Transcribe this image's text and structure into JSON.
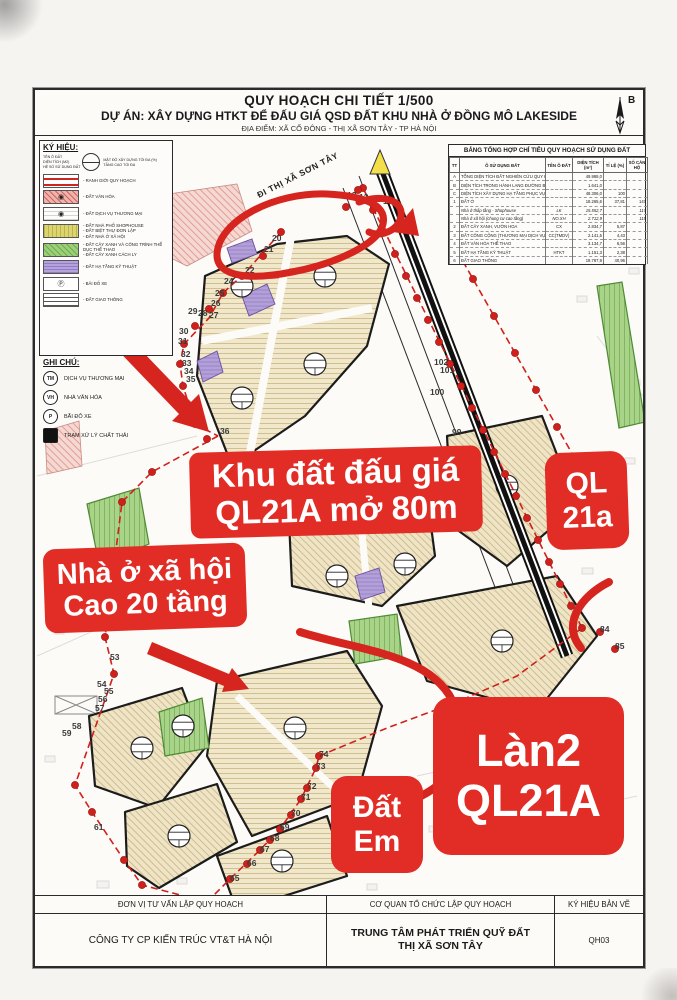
{
  "title_block": {
    "line1": "QUY HOẠCH CHI TIẾT 1/500",
    "line2": "DỰ ÁN: XÂY DỰNG HTKT ĐỂ ĐẤU GIÁ QSD ĐẤT KHU NHÀ Ở ĐỒNG MÔ LAKESIDE",
    "line3": "ĐỊA ĐIỂM: XÃ CỔ ĐÔNG - THỊ XÃ SƠN TÂY - TP HÀ NỘI",
    "north_label": "B"
  },
  "legend": {
    "title": "KÝ HIỆU:",
    "callout": {
      "left": [
        "TÊN Ô ĐẤT",
        "DIỆN TÍCH (M2)",
        "HỆ SỐ SỬ DỤNG ĐẤT"
      ],
      "right": [
        "MẬT ĐỘ XÂY DỰNG TỐI ĐA (%)",
        "TẦNG CAO TỐI ĐA"
      ]
    },
    "items": [
      {
        "swatch": "boundary",
        "icon": "",
        "lines": [
          "RANH GIỚI QUY HOẠCH"
        ]
      },
      {
        "swatch": "culture",
        "icon": "◉",
        "lines": [
          "ĐẤT VĂN HÓA"
        ]
      },
      {
        "swatch": "commerce",
        "icon": "◉",
        "lines": [
          "ĐẤT DỊCH VỤ THƯƠNG MẠI"
        ]
      },
      {
        "swatch": "residential",
        "icon": "",
        "lines": [
          "ĐẤT NHÀ PHỐ SHOPHOUSE",
          "ĐẤT BIỆT THỰ ĐƠN LẬP",
          "ĐẤT NHÀ Ở XÃ HỘI"
        ]
      },
      {
        "swatch": "green",
        "icon": "",
        "lines": [
          "ĐẤT CÂY XANH VÀ CÔNG TRÌNH THỂ DỤC THỂ THAO",
          "ĐẤT CÂY XANH CÁCH LY"
        ]
      },
      {
        "swatch": "technical",
        "icon": "",
        "lines": [
          "ĐẤT HẠ TẦNG KỸ THUẬT"
        ]
      },
      {
        "swatch": "parking",
        "icon": "Ⓟ",
        "lines": [
          "BÃI ĐỖ XE"
        ]
      },
      {
        "swatch": "road",
        "icon": "",
        "lines": [
          "ĐẤT GIAO THÔNG"
        ]
      }
    ],
    "notes_title": "GHI CHÚ:",
    "notes": [
      {
        "glyph": "TM",
        "label": "DỊCH VỤ THƯƠNG MẠI"
      },
      {
        "glyph": "VH",
        "label": "NHÀ VĂN HÓA"
      },
      {
        "glyph": "P",
        "label": "BÃI ĐỖ XE"
      },
      {
        "glyph": "▪",
        "label": "TRẠM XỬ LÝ CHẤT THẢI"
      }
    ]
  },
  "land_use_table": {
    "title": "BẢNG TỔNG HỢP CHỈ TIÊU QUY HOẠCH SỬ DỤNG ĐẤT",
    "columns": [
      "TT",
      "Ô SỬ DỤNG ĐẤT",
      "TÊN Ô ĐẤT",
      "DIỆN TÍCH (m²)",
      "TỈ LỆ (%)",
      "SỐ CĂN HỘ"
    ],
    "rows": [
      {
        "tt": "A",
        "name": "TỔNG DIỆN TÍCH ĐẤT NGHIÊN CỨU QUY HOẠCH",
        "code": "",
        "area": "49.988,0",
        "ratio": "",
        "units": "",
        "sub": false
      },
      {
        "tt": "B",
        "name": "DIỆN TÍCH TRONG HÀNH LANG ĐƯỜNG BỘ",
        "code": "",
        "area": "1.641,0",
        "ratio": "",
        "units": "",
        "sub": false
      },
      {
        "tt": "C",
        "name": "DIỆN TÍCH XÂY DỰNG HẠ TẦNG PHỤC VỤ ĐẤU GIÁ",
        "code": "",
        "area": "48.306,0",
        "ratio": "100",
        "units": "",
        "sub": false
      },
      {
        "tt": "1",
        "name": "ĐẤT Ở",
        "code": "",
        "area": "18.265,6",
        "ratio": "37,81",
        "units": "147",
        "sub": false
      },
      {
        "tt": "",
        "name": "Nhà ở thấp tầng - Shophouse",
        "code": "LK",
        "area": "15.552,7",
        "ratio": "",
        "units": "117",
        "sub": true
      },
      {
        "tt": "",
        "name": "Nhà ở xã hội (chung cư cao tầng)",
        "code": "NO.XH",
        "area": "2.712,9",
        "ratio": "",
        "units": "119",
        "sub": true
      },
      {
        "tt": "2",
        "name": "ĐẤT CÂY XANH, VƯỜN HOA",
        "code": "CX",
        "area": "2.834,7",
        "ratio": "5,87",
        "units": "",
        "sub": false
      },
      {
        "tt": "3",
        "name": "ĐẤT CÔNG CỘNG (THƯƠNG MẠI DỊCH VỤ)",
        "code": "CC(TMDV)",
        "area": "2.141,5",
        "ratio": "4,43",
        "units": "",
        "sub": false
      },
      {
        "tt": "4",
        "name": "ĐẤT VĂN HÓA THỂ THAO",
        "code": "",
        "area": "3.134,7",
        "ratio": "6,56",
        "units": "",
        "sub": false
      },
      {
        "tt": "5",
        "name": "ĐẤT HẠ TẦNG KỸ THUẬT",
        "code": "HTKT",
        "area": "1.151,3",
        "ratio": "2,38",
        "units": "",
        "sub": false
      },
      {
        "tt": "6",
        "name": "ĐẤT GIAO THÔNG",
        "code": "",
        "area": "19.787,9",
        "ratio": "40,96",
        "units": "",
        "sub": false
      }
    ]
  },
  "map": {
    "road_direction_label": "ĐI THỊ XÃ SƠN TÂY",
    "boundary_labels": [
      {
        "t": "10",
        "x": 346,
        "y": 68
      },
      {
        "t": "11",
        "x": 334,
        "y": 66
      },
      {
        "t": "12",
        "x": 322,
        "y": 64
      },
      {
        "t": "13",
        "x": 310,
        "y": 62
      },
      {
        "t": "20",
        "x": 235,
        "y": 105
      },
      {
        "t": "21",
        "x": 227,
        "y": 116
      },
      {
        "t": "22",
        "x": 208,
        "y": 137
      },
      {
        "t": "23",
        "x": 197,
        "y": 142
      },
      {
        "t": "24",
        "x": 187,
        "y": 148
      },
      {
        "t": "25",
        "x": 178,
        "y": 160
      },
      {
        "t": "26",
        "x": 174,
        "y": 170
      },
      {
        "t": "27",
        "x": 172,
        "y": 182
      },
      {
        "t": "28",
        "x": 161,
        "y": 180
      },
      {
        "t": "29",
        "x": 151,
        "y": 178
      },
      {
        "t": "30",
        "x": 142,
        "y": 198
      },
      {
        "t": "31",
        "x": 141,
        "y": 208
      },
      {
        "t": "32",
        "x": 144,
        "y": 221
      },
      {
        "t": "33",
        "x": 145,
        "y": 230
      },
      {
        "t": "34",
        "x": 147,
        "y": 238
      },
      {
        "t": "35",
        "x": 149,
        "y": 246
      },
      {
        "t": "36",
        "x": 183,
        "y": 298
      },
      {
        "t": "53",
        "x": 73,
        "y": 524
      },
      {
        "t": "54",
        "x": 60,
        "y": 551
      },
      {
        "t": "55",
        "x": 67,
        "y": 558
      },
      {
        "t": "56",
        "x": 61,
        "y": 566
      },
      {
        "t": "57",
        "x": 58,
        "y": 575
      },
      {
        "t": "58",
        "x": 35,
        "y": 593
      },
      {
        "t": "59",
        "x": 25,
        "y": 600
      },
      {
        "t": "61",
        "x": 57,
        "y": 694
      },
      {
        "t": "64",
        "x": 170,
        "y": 768
      },
      {
        "t": "65",
        "x": 193,
        "y": 745
      },
      {
        "t": "66",
        "x": 210,
        "y": 730
      },
      {
        "t": "67",
        "x": 223,
        "y": 716
      },
      {
        "t": "68",
        "x": 233,
        "y": 705
      },
      {
        "t": "69",
        "x": 243,
        "y": 694
      },
      {
        "t": "70",
        "x": 254,
        "y": 680
      },
      {
        "t": "71",
        "x": 264,
        "y": 664
      },
      {
        "t": "72",
        "x": 270,
        "y": 653
      },
      {
        "t": "73",
        "x": 279,
        "y": 633
      },
      {
        "t": "74",
        "x": 282,
        "y": 621
      },
      {
        "t": "84",
        "x": 563,
        "y": 496
      },
      {
        "t": "85",
        "x": 578,
        "y": 513
      },
      {
        "t": "99",
        "x": 415,
        "y": 299
      },
      {
        "t": "100",
        "x": 393,
        "y": 259
      },
      {
        "t": "101",
        "x": 403,
        "y": 237
      },
      {
        "t": "102",
        "x": 397,
        "y": 229
      }
    ]
  },
  "annotations": {
    "accent_color": "#e22d26",
    "auction": {
      "line1": "Khu đất đấu giá",
      "line2": "QL21A mở 80m"
    },
    "social": {
      "line1": "Nhà ở xã hội",
      "line2": "Cao 20 tầng"
    },
    "ql": {
      "line1": "QL",
      "line2": "21a"
    },
    "dat_em": {
      "line1": "Đất",
      "line2": "Em"
    },
    "lan2": {
      "line1": "Làn2",
      "line2": "QL21A"
    }
  },
  "footer": {
    "col1": {
      "header": "ĐƠN VỊ TƯ VẤN LẬP QUY HOẠCH",
      "value": "CÔNG TY CP KIẾN TRÚC VT&T HÀ NỘI"
    },
    "col2": {
      "header": "CƠ QUAN TỔ CHỨC LẬP QUY HOẠCH",
      "value_line1": "TRUNG TÂM PHÁT TRIỂN QUỸ ĐẤT",
      "value_line2": "THỊ XÃ SƠN TÂY"
    },
    "col3": {
      "header": "KÝ HIỆU BẢN VẼ",
      "value": "QH03"
    }
  }
}
